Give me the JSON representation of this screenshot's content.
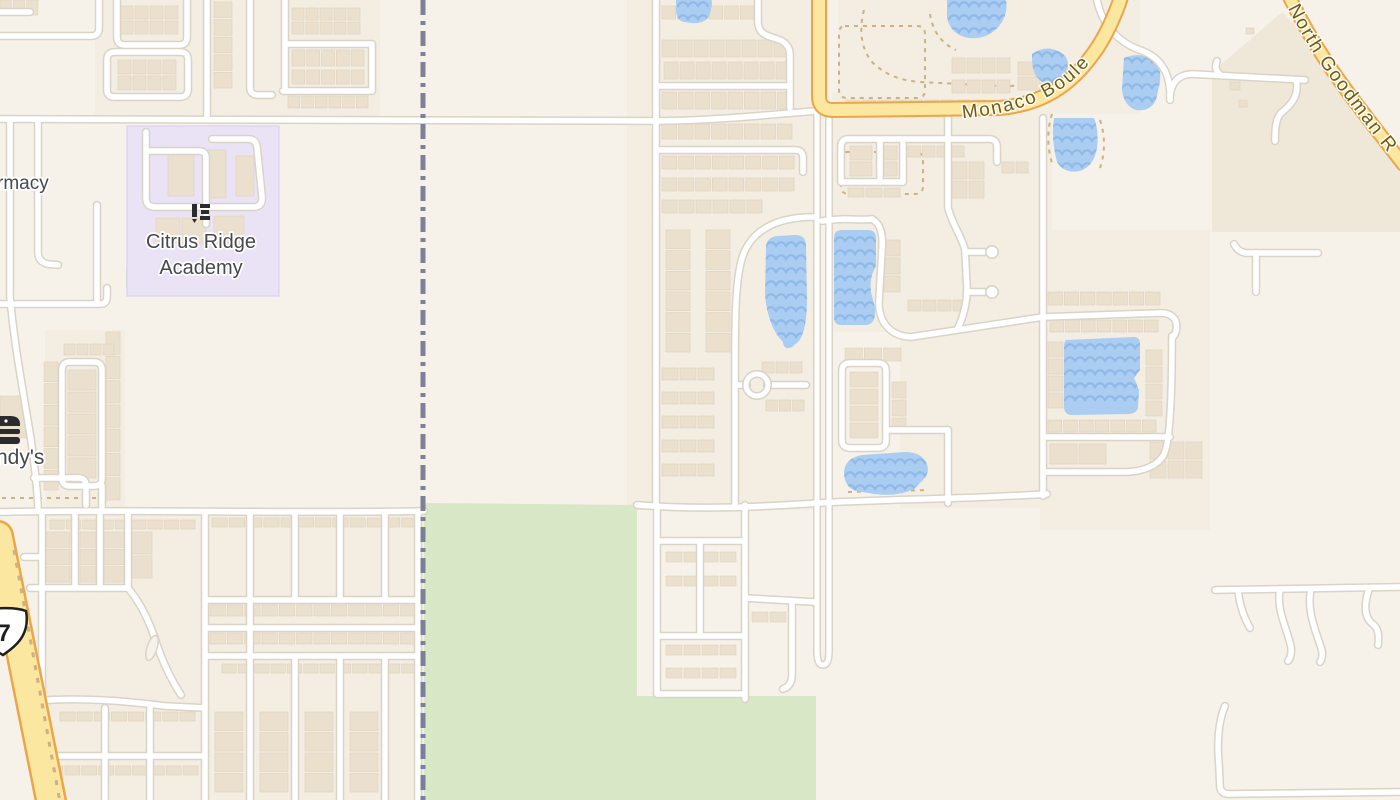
{
  "meta": {
    "width": 1400,
    "height": 800,
    "kind": "street-map-view"
  },
  "labels": {
    "school_line1": "Citrus Ridge",
    "school_line2": "Academy",
    "pharmacy_partial": "rmacy",
    "wendys_partial": "ndy's",
    "route_shield": "7",
    "monaco_road": "Monaco Boule",
    "goodman_road": "North Goodman R"
  },
  "icons": {
    "school_icon": {
      "name": "school-icon",
      "x": 191,
      "y": 202
    },
    "burger_icon": {
      "name": "fast-food-icon",
      "x": -14,
      "y": 414
    },
    "route_shield_icon": {
      "name": "us-route-shield-icon",
      "x": 0,
      "y": 0
    }
  },
  "colors": {
    "bg": "#f7f2e9",
    "panel": "#f3ede2",
    "field_tan": "#efe8d9",
    "park_green": "#d8e7c5",
    "school_purple": "#eae3f6",
    "school_purple_edge": "#dcd1ee",
    "water": "#aacdf1",
    "wave": "#8cb8e6",
    "street_casing": "#d9d3c8",
    "street_fill": "#ffffff",
    "major_fill": "#fbe7a0",
    "major_casing": "#eca648",
    "boundary": "#72778f",
    "parcel_dash": "#cdb184",
    "building_fill": "#ebe0cd",
    "building_edge": "#ded1ba",
    "label_gray": "#45484d",
    "road_label_brown": "#6e5a15",
    "icon_black": "#2a2b2e"
  },
  "map": {
    "panels": [
      [
        95,
        0,
        285,
        122
      ],
      [
        627,
        0,
        190,
        510
      ],
      [
        832,
        92,
        220,
        240
      ],
      [
        900,
        230,
        285,
        278
      ],
      [
        838,
        0,
        302,
        114
      ],
      [
        45,
        330,
        80,
        178
      ],
      [
        42,
        508,
        382,
        292
      ],
      [
        1040,
        230,
        170,
        300
      ]
    ],
    "field_tan_d": "M 1212 72 L 1252 38 L 1282 12 L 1298 28 L 1322 62 L 1352 102 L 1382 140 L 1400 158 L 1400 232 L 1212 232 Z",
    "greens": [
      "M 424 503 L 637 505 L 637 696 L 816 696 L 816 800 L 424 800 Z",
      "M 126 267 L 154 267 L 154 288 L 126 288 Z",
      "M 228 250 L 238 250 L 238 258 L 228 258 Z"
    ],
    "school_rect": [
      127,
      126,
      152,
      170
    ],
    "parcel_dashes": [
      "M 2 498 L 118 498",
      "M 845 26 L 917 26 Q 925 26 925 34 L 925 90 Q 925 98 917 98 L 847 98 Q 839 98 839 90 L 839 34 Q 839 26 845 26 Z",
      "M 847 152 L 915 152 Q 923 152 923 160 L 923 186 Q 923 194 915 194 L 849 194 Q 841 194 841 186 L 841 160 Q 841 152 847 152 Z",
      "M 864 10 Q 856 42 872 62 Q 890 80 920 82 L 1000 86 Q 1032 88 1042 70",
      "M 930 14 Q 934 40 956 50",
      "M 1100 120 Q 1108 144 1100 168",
      "M 1052 114 Q 1044 140 1053 166",
      "M 848 492 L 928 490"
    ],
    "route_dash": "M 14 550 L 60 802",
    "buildings": [
      [
        0,
        0,
        38,
        15,
        3,
        1
      ],
      [
        120,
        6,
        58,
        28,
        4,
        2
      ],
      [
        292,
        8,
        68,
        26,
        5,
        2
      ],
      [
        292,
        50,
        72,
        16,
        5,
        1
      ],
      [
        292,
        70,
        72,
        14,
        5,
        1
      ],
      [
        288,
        96,
        80,
        12,
        6,
        1
      ],
      [
        214,
        2,
        18,
        86,
        1,
        5
      ],
      [
        118,
        60,
        58,
        30,
        4,
        2
      ],
      [
        168,
        152,
        26,
        44,
        1,
        1
      ],
      [
        204,
        150,
        22,
        48,
        1,
        1
      ],
      [
        236,
        156,
        18,
        40,
        1,
        1
      ],
      [
        156,
        218,
        50,
        26,
        2,
        1
      ],
      [
        214,
        216,
        30,
        28,
        1,
        1
      ],
      [
        44,
        362,
        14,
        128,
        1,
        6
      ],
      [
        68,
        370,
        28,
        108,
        1,
        5
      ],
      [
        106,
        332,
        14,
        168,
        1,
        7
      ],
      [
        64,
        344,
        50,
        11,
        4,
        1
      ],
      [
        0,
        396,
        26,
        42,
        1,
        1
      ],
      [
        50,
        520,
        145,
        9,
        9,
        1
      ],
      [
        212,
        518,
        205,
        9,
        12,
        1
      ],
      [
        46,
        532,
        24,
        50,
        1,
        3
      ],
      [
        80,
        532,
        16,
        50,
        1,
        3
      ],
      [
        104,
        532,
        20,
        50,
        1,
        3
      ],
      [
        132,
        532,
        20,
        46,
        1,
        2
      ],
      [
        210,
        605,
        206,
        11,
        12,
        1
      ],
      [
        210,
        633,
        206,
        11,
        12,
        1
      ],
      [
        222,
        664,
        194,
        9,
        12,
        1
      ],
      [
        60,
        712,
        135,
        9,
        8,
        1
      ],
      [
        48,
        766,
        150,
        9,
        9,
        1
      ],
      [
        215,
        712,
        28,
        80,
        1,
        4
      ],
      [
        260,
        712,
        28,
        80,
        1,
        4
      ],
      [
        305,
        712,
        28,
        80,
        1,
        4
      ],
      [
        350,
        712,
        28,
        80,
        1,
        4
      ],
      [
        662,
        6,
        92,
        13,
        6,
        1
      ],
      [
        662,
        40,
        126,
        17,
        8,
        1
      ],
      [
        664,
        62,
        126,
        17,
        8,
        1
      ],
      [
        662,
        92,
        130,
        17,
        8,
        1
      ],
      [
        662,
        124,
        130,
        15,
        8,
        1
      ],
      [
        662,
        156,
        132,
        13,
        8,
        1
      ],
      [
        662,
        178,
        132,
        13,
        8,
        1
      ],
      [
        662,
        200,
        100,
        13,
        6,
        1
      ],
      [
        666,
        230,
        24,
        122,
        1,
        6
      ],
      [
        706,
        230,
        24,
        122,
        1,
        6
      ],
      [
        662,
        368,
        52,
        12,
        3,
        1
      ],
      [
        662,
        392,
        52,
        12,
        3,
        1
      ],
      [
        662,
        416,
        52,
        12,
        3,
        1
      ],
      [
        662,
        440,
        52,
        12,
        3,
        1
      ],
      [
        662,
        464,
        52,
        12,
        3,
        1
      ],
      [
        762,
        362,
        40,
        11,
        3,
        1
      ],
      [
        766,
        400,
        38,
        11,
        3,
        1
      ],
      [
        666,
        552,
        70,
        10,
        4,
        1
      ],
      [
        666,
        576,
        70,
        10,
        4,
        1
      ],
      [
        666,
        645,
        70,
        10,
        4,
        1
      ],
      [
        666,
        668,
        70,
        10,
        4,
        1
      ],
      [
        752,
        612,
        34,
        10,
        2,
        1
      ],
      [
        846,
        100,
        140,
        11,
        9,
        1
      ],
      [
        850,
        146,
        22,
        30,
        1,
        2
      ],
      [
        884,
        146,
        13,
        30,
        1,
        2
      ],
      [
        908,
        146,
        56,
        11,
        4,
        1
      ],
      [
        848,
        188,
        52,
        9,
        3,
        1
      ],
      [
        952,
        162,
        32,
        36,
        2,
        2
      ],
      [
        1002,
        162,
        26,
        11,
        2,
        1
      ],
      [
        884,
        240,
        16,
        52,
        1,
        3
      ],
      [
        845,
        348,
        56,
        13,
        3,
        1
      ],
      [
        850,
        372,
        28,
        66,
        1,
        4
      ],
      [
        892,
        382,
        14,
        52,
        1,
        3
      ],
      [
        908,
        300,
        58,
        11,
        4,
        1
      ],
      [
        952,
        58,
        58,
        15,
        4,
        1
      ],
      [
        952,
        80,
        58,
        13,
        4,
        1
      ],
      [
        1018,
        62,
        40,
        28,
        2,
        2
      ],
      [
        1048,
        292,
        112,
        13,
        7,
        1
      ],
      [
        1050,
        320,
        108,
        12,
        7,
        1
      ],
      [
        1048,
        342,
        15,
        66,
        1,
        4
      ],
      [
        1048,
        420,
        108,
        12,
        7,
        1
      ],
      [
        1050,
        444,
        56,
        20,
        2,
        1
      ],
      [
        1146,
        350,
        16,
        66,
        1,
        4
      ],
      [
        1150,
        442,
        52,
        36,
        3,
        2
      ],
      [
        1230,
        82,
        10,
        8,
        1,
        1
      ],
      [
        1239,
        100,
        8,
        7,
        1,
        1
      ],
      [
        1246,
        28,
        8,
        6,
        1,
        1
      ]
    ],
    "waters": [
      {
        "d": "M 676 -6 L 704 -6 Q 712 -6 712 4 L 710 14 Q 706 24 692 23 L 684 22 Q 676 20 676 10 Z",
        "bbox": [
          676,
          -6,
          36,
          30
        ]
      },
      {
        "d": "M 947 -6 L 1004 -6 Q 1010 8 1002 22 Q 990 40 969 38 Q 951 35 947 18 Z",
        "bbox": [
          947,
          -6,
          60,
          46
        ]
      },
      {
        "d": "M 1032 54 Q 1046 44 1060 52 Q 1071 58 1067 72 Q 1061 85 1045 83 Q 1031 78 1032 54 Z",
        "bbox": [
          1030,
          44,
          42,
          42
        ]
      },
      {
        "d": "M 1124 58 Q 1138 52 1150 58 Q 1162 64 1160 82 L 1156 100 Q 1150 112 1136 110 Q 1124 106 1122 90 Z",
        "bbox": [
          1120,
          50,
          44,
          62
        ]
      },
      {
        "d": "M 1054 118 L 1094 118 Q 1099 130 1097 148 Q 1094 166 1080 171 Q 1064 174 1057 162 Q 1051 140 1054 118 Z",
        "bbox": [
          1050,
          116,
          50,
          58
        ]
      },
      {
        "d": "M 766 248 Q 766 237 778 236 L 795 235 Q 806 235 806 246 L 807 298 Q 807 330 799 341 L 792 347 Q 784 351 783 342 Q 768 327 765 295 Z",
        "bbox": [
          764,
          234,
          44,
          118
        ]
      },
      {
        "d": "M 834 238 Q 834 230 842 230 L 868 230 Q 876 230 876 238 L 876 266 Q 869 277 871 292 L 875 308 Q 876 324 867 325 L 841 325 Q 834 325 834 317 Z",
        "bbox": [
          833,
          229,
          44,
          98
        ]
      },
      {
        "d": "M 1066 340 L 1134 337 Q 1140 337 1140 344 L 1140 370 L 1134 378 L 1139 390 L 1138 408 Q 1136 414 1128 414 L 1072 415 Q 1064 415 1064 406 L 1064 348 Q 1064 341 1066 340 Z",
        "bbox": [
          1063,
          336,
          78,
          80
        ]
      },
      {
        "d": "M 844 472 Q 845 458 862 455 L 905 452 Q 920 452 926 462 Q 931 472 923 480 L 914 489 Q 898 497 874 494 L 856 491 Q 844 487 844 472 Z",
        "bbox": [
          843,
          451,
          90,
          46
        ]
      }
    ],
    "streets": [
      "M 0 119 C 300 120 520 122 660 121 C 725 120 775 114 816 111",
      "M 0 36 L 91 36 Q 99 36 99 28 L 99 0",
      "M 0 12 L 30 12",
      "M 207 0 L 207 119",
      "M 107 90 Q 107 97 115 97 L 180 97 Q 188 97 188 89 L 188 60 Q 188 52 180 52 L 115 52 Q 107 52 107 60 Z",
      "M 117 0 L 117 37 Q 117 45 125 45 L 179 45 Q 187 45 187 37 L 187 0",
      "M 250 0 L 250 87 Q 250 95 258 95 L 272 95",
      "M 285 0 L 285 91",
      "M 285 44 L 372 44",
      "M 372 44 L 372 91",
      "M 283 91 L 372 91",
      "M 146 132 L 146 198 Q 146 207 155 207 L 256 207 Q 263 205 262 196 L 257 147 Q 256 139 248 139 L 212 139",
      "M 146 151 L 199 151 Q 206 151 206 158 L 206 207",
      "M 206 207 L 206 224",
      "M 10 119 L 10 296 C 14 345 24 395 31 440 C 35 468 37 487 38 507",
      "M 38 119 L 38 252 Q 38 262 48 264 L 58 265",
      "M 97 205 L 97 304",
      "M 0 304 L 100 304 Q 107 304 107 297 L 107 288",
      "M 34 478 L 79 478 Q 86 478 86 486 L 86 505",
      "M 62 370 Q 62 362 70 362 L 94 362 Q 102 362 102 370 L 102 478 Q 102 486 94 486 L 70 486 Q 62 486 62 478 Z",
      "M 102 486 L 102 507",
      "M 0 512 C 120 509 300 514 424 511",
      "M 24 557 L 42 557",
      "M 42 512 L 42 800",
      "M 75 512 L 75 588",
      "M 100 512 L 100 588",
      "M 128 512 L 128 588",
      "M 30 588 L 128 588",
      "M 128 588 C 139 601 149 620 156 642 C 162 660 168 673 175 685 L 181 695",
      "M 205 512 L 205 800",
      "M 250 512 L 250 800",
      "M 295 512 L 295 600",
      "M 340 512 L 340 600",
      "M 385 512 L 385 600",
      "M 418 512 L 418 800",
      "M 205 600 L 418 600",
      "M 205 628 L 418 628",
      "M 205 656 L 418 656",
      "M 295 656 L 295 800",
      "M 340 656 L 340 800",
      "M 385 656 L 385 800",
      "M 35 701 C 80 697 125 701 165 706 L 205 708",
      "M 42 756 L 205 756",
      "M 105 708 L 105 800",
      "M 150 708 L 150 800",
      "M 656 0 L 656 504",
      "M 758 0 L 758 22 Q 758 32 768 36 L 780 40 Q 790 45 790 55 L 790 108",
      "M 657 86 L 788 86",
      "M 657 150 L 795 150 Q 803 150 803 158 L 803 172",
      "M 813 217 C 773 217 748 233 741 262 C 736 283 735 310 735 365 L 735 504",
      "M 822 221 C 845 217 860 221 872 219",
      "M 872 219 C 881 224 883 234 882 250 L 879 300 C 878 322 890 336 911 337",
      "M 911 337 L 1043 317 L 1160 313 Q 1173 313 1176 322 Q 1178 331 1173 337",
      "M 735 385 L 747 385",
      "M 767 385 L 806 385",
      "M 842 371 Q 842 363 850 363 L 878 363 Q 886 363 886 371 L 886 440 Q 886 448 878 448 L 850 448 Q 842 448 842 440 Z",
      "M 886 430 L 948 430",
      "M 948 430 L 948 503",
      "M 637 505 C 700 510 760 507 820 503 C 880 499 950 500 1047 494",
      "M 657 505 L 657 694",
      "M 745 505 L 745 699",
      "M 700 541 L 700 636",
      "M 657 541 L 745 541",
      "M 657 636 L 745 636",
      "M 657 694 L 745 694",
      "M 745 598 L 814 602",
      "M 792 602 L 792 674 Q 792 686 783 689",
      "M 848 139 L 989 139 Q 997 139 997 147 L 997 162",
      "M 848 139 Q 841 139 841 147 L 841 182",
      "M 841 182 L 903 182",
      "M 880 139 L 880 182",
      "M 903 139 L 903 182",
      "M 948 118 L 948 208 C 953 226 962 237 965 250 L 967 288 C 967 305 963 318 957 330",
      "M 966 252 L 986 252",
      "M 967 292 L 988 292",
      "M 1043 118 L 1043 496",
      "M 1043 437 L 1170 437",
      "M 1043 472 L 1128 472 Q 1154 470 1163 456 Q 1172 444 1172 336",
      "M 1097 0 C 1102 25 1118 42 1140 50 C 1160 57 1169 72 1170 92 L 1170 100",
      "M 1170 96 Q 1172 75 1192 74 L 1305 80",
      "M 1222 76 Q 1213 70 1217 61",
      "M 1296 80 C 1300 96 1290 106 1281 113 C 1276 118 1275 128 1275 141",
      "M 1234 244 Q 1238 252 1246 253 L 1318 253",
      "M 1256 253 L 1256 292",
      "M 1215 590 L 1400 587",
      "M 1238 590 C 1240 608 1245 619 1250 628",
      "M 1280 589 C 1276 610 1287 628 1291 647 Q 1292 656 1288 661",
      "M 1311 589 C 1306 612 1317 633 1322 651 Q 1323 658 1320 662",
      "M 1369 589 C 1363 607 1365 619 1374 625 Q 1380 631 1378 645",
      "M 1225 706 C 1218 722 1217 745 1219 765 L 1220 787 Q 1221 794 1229 794 L 1400 792"
    ],
    "divided_road": "M 817 110 L 817 651 Q 817 665 823 665 Q 829 665 829 651 L 829 110",
    "bulbs": [
      [
        992,
        252,
        7
      ],
      [
        992,
        292,
        7
      ]
    ],
    "cul_ring": [
      757,
      385,
      11
    ],
    "island": {
      "cx": 152,
      "cy": 648,
      "rx": 5,
      "ry": 13,
      "rot": 18
    },
    "majors": [
      {
        "name": "us-27-highway",
        "d": "M -2 536 L 52 806",
        "w": 27,
        "cw": 32
      },
      {
        "name": "monaco-boulevard-road",
        "d": "M 819 -6 L 819 96 Q 819 110 833 110 L 1000 108 C 1042 104 1070 86 1093 54 C 1105 38 1116 14 1122 -6",
        "w": 12,
        "cw": 16
      },
      {
        "name": "north-goodman-road",
        "d": "M 1287 -8 C 1305 30 1326 63 1350 95 C 1368 119 1386 142 1403 164",
        "w": 11,
        "cw": 15
      }
    ],
    "label_paths": {
      "monaco": "M 960 113 C 1005 109 1046 99 1076 70 C 1094 52 1108 30 1118 6",
      "goodman": "M 1290 0 C 1308 36 1328 67 1351 96 C 1369 120 1387 143 1402 161"
    },
    "boundary_d": "M 423 0 L 423 800",
    "shield_d": "M -20 612 C -8 607 16 607 26 611 C 28 622 26 632 20 640 C 14 648 7 652 3 655 C -2 652 -10 648 -16 640 C -22 632 -23 621 -20 612 Z",
    "text_anchors": {
      "school": {
        "x": 201,
        "y1": 248,
        "y2": 274,
        "size": 20
      },
      "pharmacy": {
        "x": -3,
        "y": 189,
        "size": 19
      },
      "wendys": {
        "x": -4,
        "y": 464,
        "size": 21
      },
      "shield_num": {
        "x": 4,
        "y": 641,
        "size": 24
      }
    }
  }
}
